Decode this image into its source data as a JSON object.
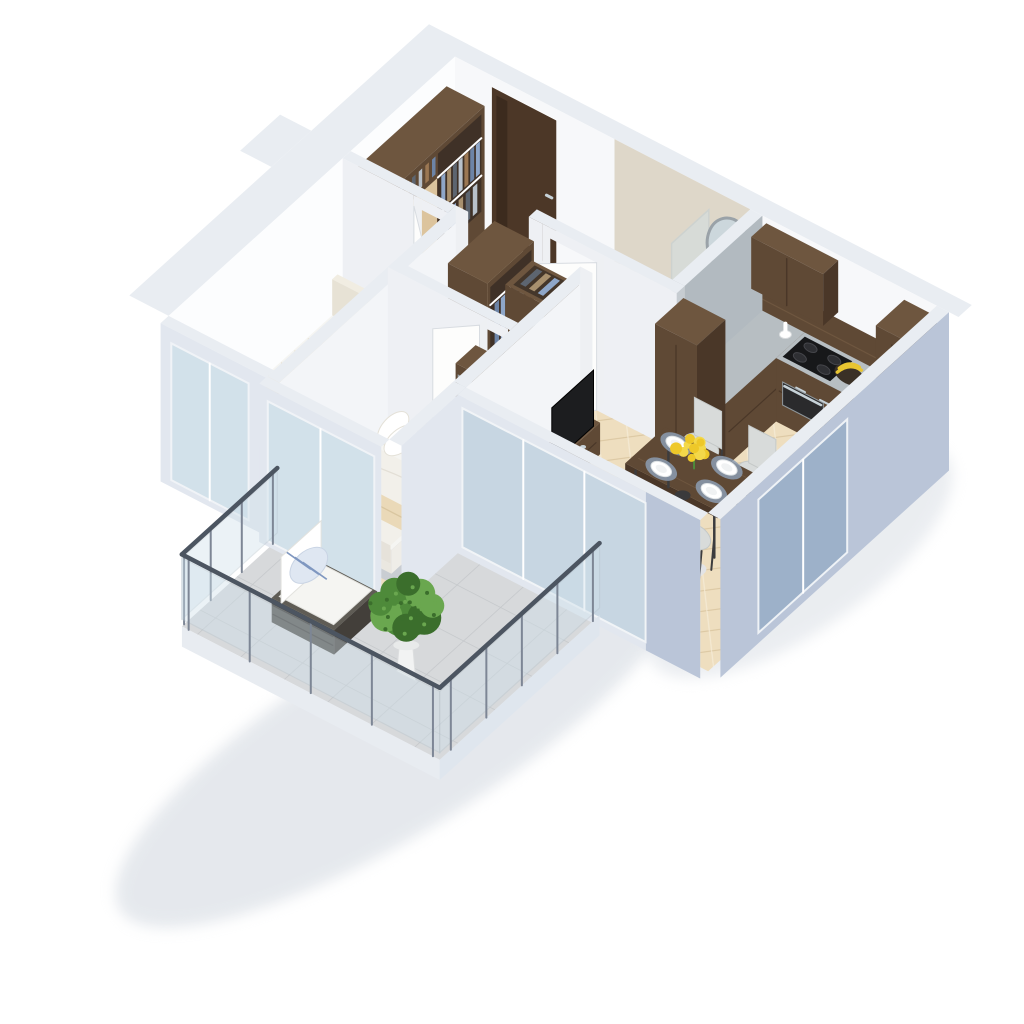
{
  "scene": {
    "type": "3d-floor-plan-render",
    "style": "isometric-dollhouse-cutaway-apartment",
    "background": "#ffffff",
    "rooms": [
      {
        "name": "entry-hall",
        "floor": "herringbone-parquet",
        "items": [
          "entrance-door",
          "entry-closet"
        ]
      },
      {
        "name": "bathroom",
        "floor": "gray-terrazzo",
        "items": [
          "bathtub",
          "shower-screen",
          "wall-mirror",
          "wash-basin",
          "vanity-cabinet",
          "toilet",
          "bathroom-door"
        ]
      },
      {
        "name": "kitchen",
        "floor": "herringbone-parquet",
        "items": [
          "upper-cabinet",
          "wood-backsplash",
          "stone-countertop",
          "induction-cooktop",
          "oven",
          "kitchen-sink",
          "banana-bowl",
          "utensil-crock",
          "tall-cabinet-west",
          "tall-cabinet-east",
          "base-cabinets"
        ]
      },
      {
        "name": "dining-area",
        "floor": "herringbone-parquet",
        "items": [
          "dining-table",
          "dining-chair",
          "place-setting",
          "flower-centerpiece"
        ]
      },
      {
        "name": "living-room",
        "floor": "herringbone-parquet",
        "items": [
          "orange-sofa",
          "sofa-pillow",
          "coffee-table",
          "table-plant",
          "living-rug",
          "tv-console",
          "television",
          "floor-lamp"
        ]
      },
      {
        "name": "hallway",
        "floor": "herringbone-parquet",
        "items": [
          "open-wardrobe-a",
          "open-wardrobe-b",
          "mirror-wardrobe",
          "interior-door",
          "yellow-stool"
        ]
      },
      {
        "name": "bedroom-1",
        "floor": "herringbone-parquet",
        "items": [
          "double-bed-beige",
          "bed-pillow",
          "gray-rug",
          "desk",
          "desk-chair",
          "bedroom-floor-lamp",
          "window"
        ]
      },
      {
        "name": "bedroom-2",
        "floor": "herringbone-parquet",
        "items": [
          "double-bed-white",
          "pillow-set",
          "folded-blanket",
          "light-rug",
          "balcony-slider"
        ]
      },
      {
        "name": "balcony",
        "floor": "stone-tiles",
        "items": [
          "glass-railing",
          "rattan-lounge-chair",
          "striped-pillow",
          "potted-bush"
        ]
      }
    ],
    "palette": {
      "wallTop": "#e9edf2",
      "wallFaceN": "#f7f8fa",
      "wallFaceW": "#fcfdfe",
      "wallFacePart": "#f3f5f8",
      "wallFacePartY": "#eef0f4",
      "wallExtBlue": "#bac5d8",
      "wallExtLight": "#e2e7ef",
      "wallCap": "#eef0f3",
      "bathWall": "#ded7c9",
      "stoneSplash": "#b2bac0",
      "parqBase": "#eedebf",
      "parqLine1": "#dcc8a3",
      "parqLine2": "#f6ecd6",
      "bathFloor": "#b6bcc2",
      "bathFloorDot": "#a9b0b7",
      "balcTile": "#d7d9db",
      "balcLine": "#c4c7ca",
      "woodDark": "#5f4935",
      "woodDarkHi": "#6e563f",
      "woodDarkLo": "#4a3728",
      "woodDoorLight": "#dcc49d",
      "counter": "#b7bec2",
      "cooktop": "#17181a",
      "steel": "#c7d2d8",
      "sinkSteel": "#b9c9d2",
      "banana": "#e8c531",
      "white": "#ffffff",
      "softWhite": "#f5f5f2",
      "cream": "#ead9b8",
      "bedBeige": "#ebdec5",
      "quilt": "#dbcba8",
      "pillow": "#f6efdd",
      "rug1": "#9ba3ac",
      "rug2": "#c9cdd2",
      "rugLiving": "#e3e4e6",
      "sofa": "#d98b30",
      "sofaHi": "#e09a47",
      "sofaLo": "#bd7524",
      "glass": "#cfe0ea",
      "glassBlue": "#9db1c9",
      "railDark": "#4c5561",
      "post": "#7d8695",
      "green": "#4e8a3a",
      "greenHi": "#6aa74f",
      "greenLo": "#3b6e2c",
      "pot": "#f2f3f3",
      "chairShell": "#d8dbda",
      "chairLeg": "#3c3c3e",
      "mat": "#8c9cb1",
      "flower": "#eec829",
      "flowerHi": "#f3d84a",
      "doorWalnut": "#4c3727",
      "doorWalnutLo": "#3c2b1e",
      "mirror": "#ccd7dc",
      "mirrorFrame": "#9aa2a8",
      "tv": "#1c1d1f",
      "deskWood": "#d2b88f",
      "chairTan": "#c4a47f",
      "wicker": "#4f4d48",
      "wickerHi": "#5f5c55",
      "wickerLo": "#433f3a",
      "stripe": "#7f97c0",
      "lampDark": "#3a3a3c",
      "shadow": "#ccd3dc",
      "clothes": [
        "#8ea6c8",
        "#6d84a6",
        "#9b7753",
        "#b8c1cb",
        "#5d6570",
        "#a8906e"
      ]
    }
  }
}
